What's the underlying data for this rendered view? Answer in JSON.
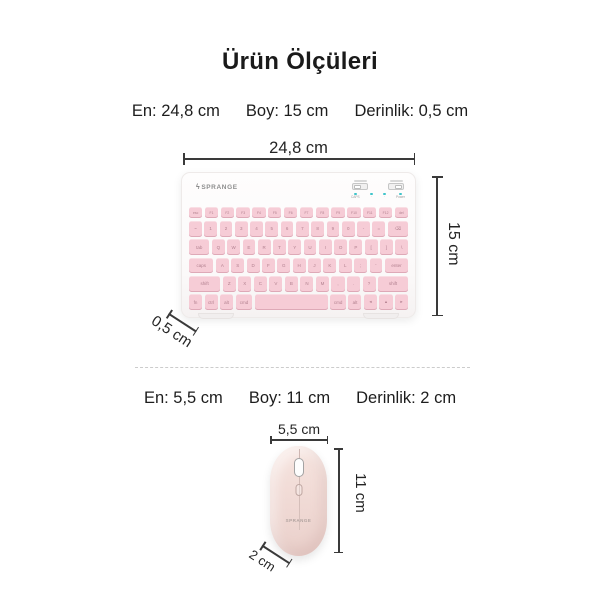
{
  "title": "Ürün Ölçüleri",
  "keyboard": {
    "specs": [
      "En: 24,8 cm",
      "Boy: 15 cm",
      "Derinlik: 0,5 cm"
    ],
    "width_label": "24,8 cm",
    "height_label": "15 cm",
    "depth_label": "0,5 cm",
    "brand": "SPRANGE",
    "logo_glyph": "ϟ",
    "indicators": [
      "CAPS",
      "·",
      "·",
      "Power"
    ],
    "key_rows": [
      [
        "esc",
        "F1",
        "F2",
        "F3",
        "F4",
        "F5",
        "F6",
        "F7",
        "F8",
        "F9",
        "F10",
        "F11",
        "F12",
        "del"
      ],
      [
        "~",
        "1",
        "2",
        "3",
        "4",
        "5",
        "6",
        "7",
        "8",
        "9",
        "0",
        "-",
        "=",
        [
          "⌫",
          1.6
        ]
      ],
      [
        [
          "tab",
          1.6
        ],
        "Q",
        "W",
        "E",
        "R",
        "T",
        "Y",
        "U",
        "I",
        "O",
        "P",
        "[",
        "]",
        "\\"
      ],
      [
        [
          "caps",
          1.9
        ],
        "A",
        "S",
        "D",
        "F",
        "G",
        "H",
        "J",
        "K",
        "L",
        ";",
        "'",
        [
          "enter",
          1.8
        ]
      ],
      [
        [
          "shift",
          2.4
        ],
        "Z",
        "X",
        "C",
        "V",
        "B",
        "N",
        "M",
        ",",
        ".",
        "?",
        [
          "shift",
          2.3
        ]
      ],
      [
        "fn",
        "ctrl",
        "alt",
        [
          "cmd",
          1.3
        ],
        [
          "",
          5.6
        ],
        [
          "cmd",
          1.2
        ],
        "alt",
        "◂",
        "▴",
        "▸"
      ]
    ]
  },
  "mouse": {
    "specs": [
      "En: 5,5 cm",
      "Boy: 11 cm",
      "Derinlik: 2 cm"
    ],
    "width_label": "5,5 cm",
    "height_label": "11 cm",
    "depth_label": "2 cm",
    "brand": "SPRANGE"
  },
  "colors": {
    "background": "#ffffff",
    "text": "#1d1d1d",
    "dimension_line": "#3a3a3a",
    "key_pink": "#f6ccd6",
    "mouse_pink": "#f1dbd6",
    "led_teal": "#3fc4ca"
  }
}
